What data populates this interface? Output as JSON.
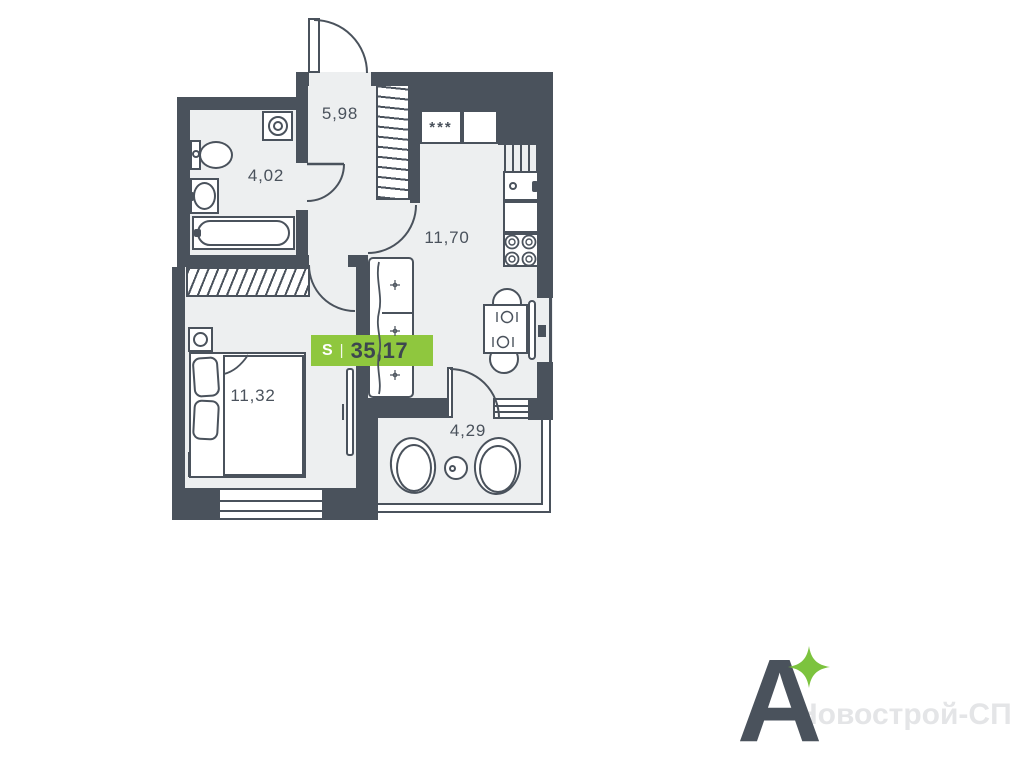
{
  "plan": {
    "badge": {
      "s_label": "S",
      "separator": "|",
      "total_area": "35,17"
    },
    "rooms": [
      {
        "name": "hallway",
        "area": "5,98"
      },
      {
        "name": "bathroom",
        "area": "4,02"
      },
      {
        "name": "kitchen-living",
        "area": "11,70"
      },
      {
        "name": "bedroom",
        "area": "11,32"
      },
      {
        "name": "loggia",
        "area": "4,29"
      }
    ],
    "fridge_marker": "***"
  },
  "branding": {
    "logo_letter": "A",
    "watermark": "Новострой-СПб"
  },
  "colors": {
    "wall": "#4a525c",
    "floor": "#edeff0",
    "badge_green": "#8fc73e",
    "badge_text": "#3d464f",
    "star_green": "#7cc33e",
    "watermark": "#e4e5e7"
  }
}
